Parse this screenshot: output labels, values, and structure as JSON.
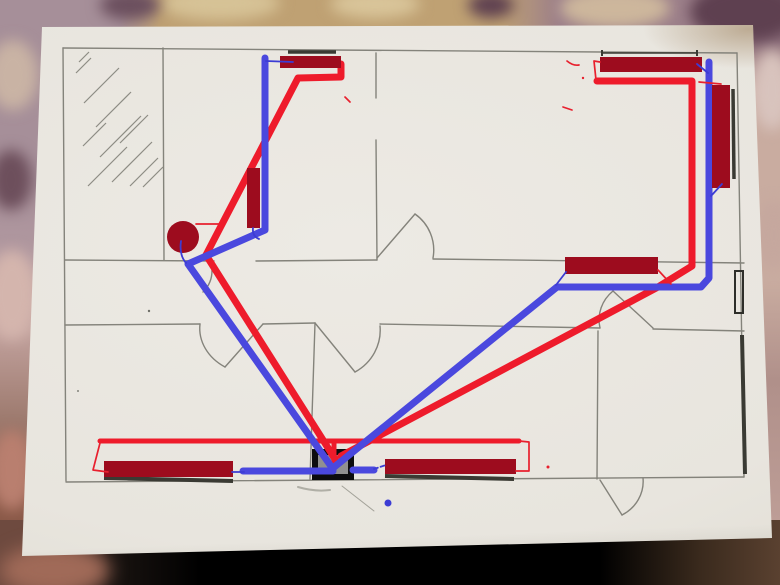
{
  "meta": {
    "description": "Photograph of a sheet of paper lying on floral fabric; the paper bears a pencil floor plan of an apartment overlaid with a hand-drawn heating scheme in marker",
    "drawing_type": "heating piping diagram on floor plan",
    "visible_text": ""
  },
  "palette": {
    "paper": "#e9e6df",
    "pencil_line": "#84837b",
    "radiator_fill": "#9d0c1e",
    "supply_pipe_red": "#ee1b2b",
    "return_pipe_blue": "#4a48de",
    "boiler_black": "#0c0c0e",
    "boiler_inner_gray": "#909090",
    "window_mark_dark": "#3a3a33",
    "fabric_mauve": "#a98b93",
    "fabric_tan": "#bfa173",
    "fabric_plum": "#5e4050",
    "fabric_rose": "#c9aca0",
    "lap_shadow": "#0d0a08"
  },
  "components": {
    "radiator_count": 7,
    "radiators": [
      "top-center horizontal radiator under top-wall window",
      "small vertical radiator left of center",
      "top-right horizontal radiator under top-wall window",
      "right-wall vertical radiator beside window",
      "middle-right horizontal radiator on middle wall",
      "bottom-left horizontal radiator over bottom window",
      "bottom-center-right horizontal radiator over bottom window"
    ],
    "boiler": "black rectangle on bottom wall where all pipes converge",
    "pump": "dark red filled circle near left-center junction",
    "pipes": {
      "supply": "red lines from boiler to each radiator",
      "return": "blue lines from radiators back to boiler"
    },
    "rooms": "six rooms with pencil walls, five door arcs, hatched area top-left",
    "extra_marks": [
      "small blue dot below bottom-right radiator",
      "stray red dashes",
      "pencil smudges"
    ]
  }
}
